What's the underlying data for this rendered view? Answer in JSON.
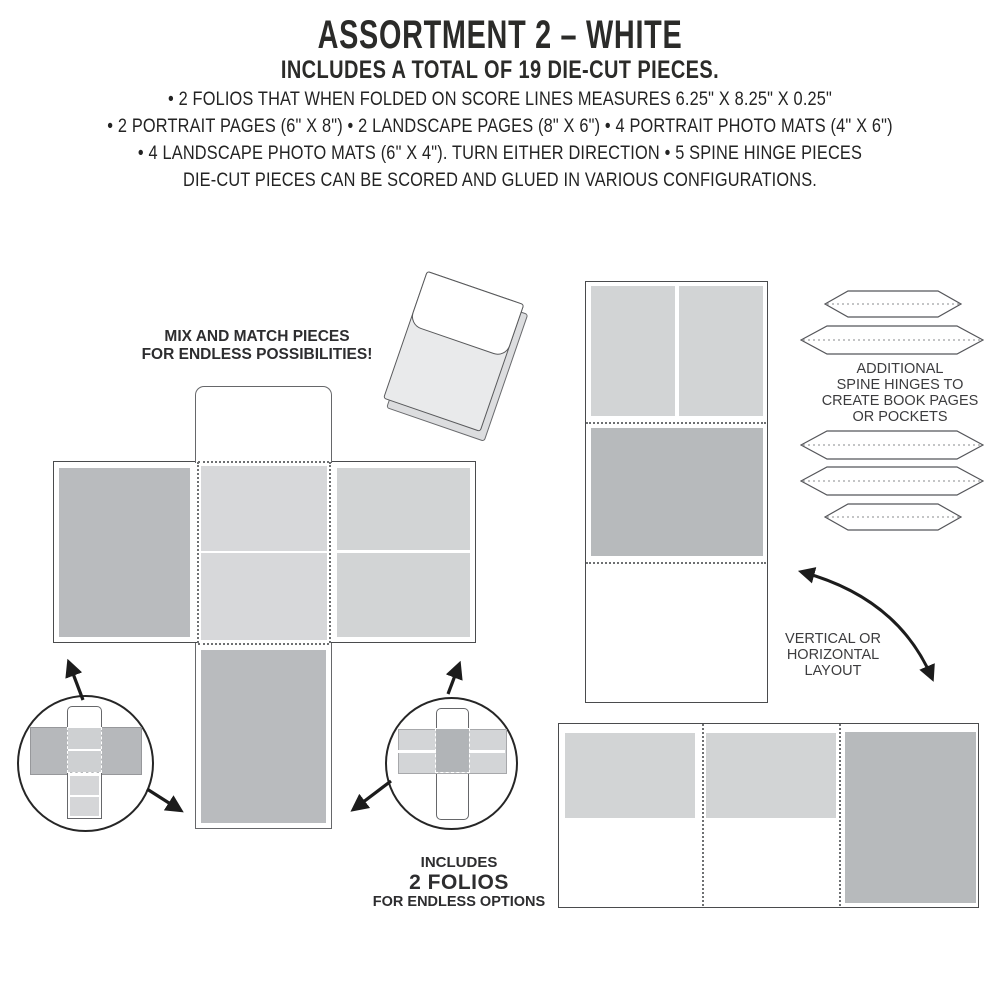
{
  "header": {
    "title": "ASSORTMENT 2 – WHITE",
    "subtitle": "INCLUDES A TOTAL OF 19 DIE-CUT PIECES.",
    "detail_lines": [
      "• 2 FOLIOS THAT WHEN FOLDED ON SCORE LINES MEASURES 6.25\" X 8.25\" X 0.25\"",
      "• 2 PORTRAIT PAGES (6\" X 8\") • 2 LANDSCAPE PAGES (8\" X 6\") • 4 PORTRAIT PHOTO MATS (4\" X 6\")",
      "• 4 LANDSCAPE PHOTO MATS (6\" X 4\"). TURN EITHER DIRECTION • 5 SPINE HINGE PIECES",
      "DIE-CUT PIECES CAN BE SCORED AND GLUED IN VARIOUS CONFIGURATIONS."
    ]
  },
  "annotations": {
    "mix_match_line1": "MIX AND MATCH PIECES",
    "mix_match_line2": "FOR ENDLESS POSSIBILITIES!",
    "spine_hinges_line1": "ADDITIONAL",
    "spine_hinges_line2": "SPINE HINGES TO",
    "spine_hinges_line3": "CREATE BOOK PAGES",
    "spine_hinges_line4": "OR POCKETS",
    "orientation_line1": "VERTICAL OR",
    "orientation_line2": "HORIZONTAL",
    "orientation_line3": "LAYOUT",
    "includes_line1": "INCLUDES",
    "includes_line2": "2 FOLIOS",
    "includes_line3": "FOR ENDLESS OPTIONS"
  },
  "product": {
    "total_die_cut_pieces": 19,
    "folios": 2,
    "spine_hinge_pieces": 5
  },
  "colors": {
    "background": "#ffffff",
    "panel_dark_gray": "#b9bbbe",
    "panel_light_gray": "#d2d4d5",
    "outline_dark": "#4a4b4d",
    "outline_gray": "#66676a",
    "score_line": "#6e7072",
    "arrow_black": "#1c1c1c",
    "text_dark": "#2b2b29"
  }
}
